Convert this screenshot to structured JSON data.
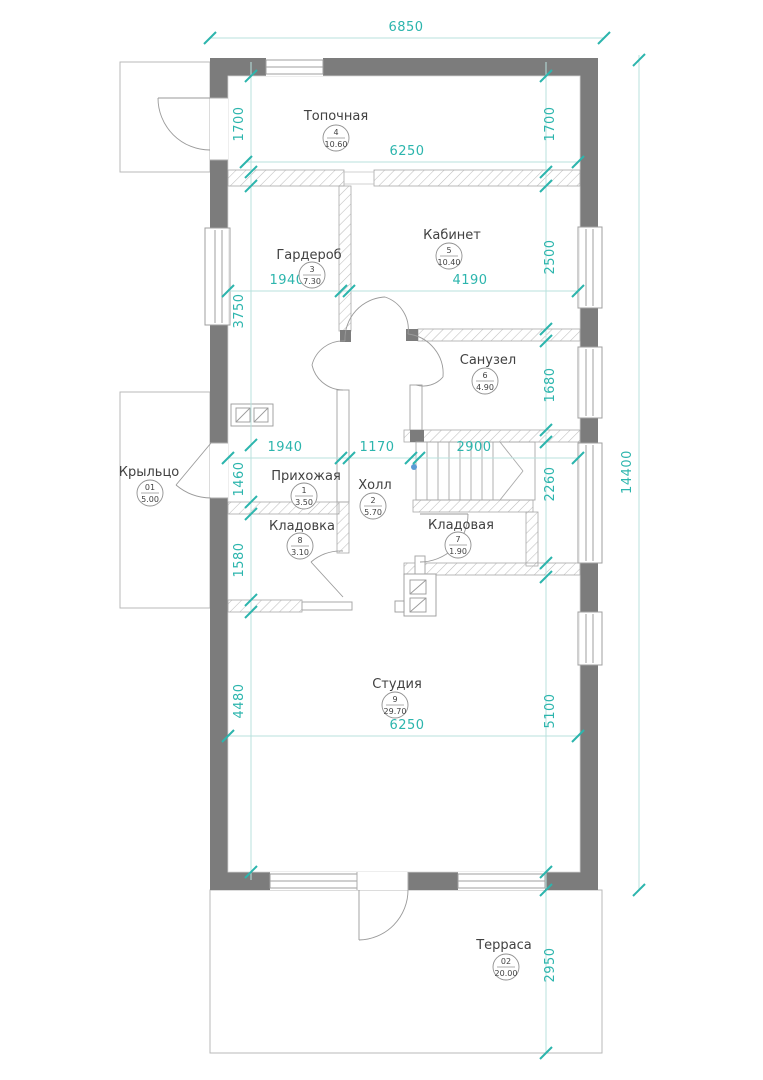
{
  "plan": {
    "title": "floor-plan",
    "colors": {
      "wall": "#7c7c7c",
      "dimension_accent": "#2cb5ad",
      "dimension_line": "#b9e2de",
      "thin_line": "#b9b9b9",
      "text": "#414141",
      "stair_dot": "#5b9bd5"
    },
    "rooms": [
      {
        "name": "Топочная",
        "number": "4",
        "area": "10.60"
      },
      {
        "name": "Гардероб",
        "number": "3",
        "area": "7.30"
      },
      {
        "name": "Кабинет",
        "number": "5",
        "area": "10.40"
      },
      {
        "name": "Санузел",
        "number": "6",
        "area": "4.90"
      },
      {
        "name": "Прихожая",
        "number": "1",
        "area": "3.50"
      },
      {
        "name": "Холл",
        "number": "2",
        "area": "5.70"
      },
      {
        "name": "Кладовка",
        "number": "8",
        "area": "3.10"
      },
      {
        "name": "Кладовая",
        "number": "7",
        "area": "1.90"
      },
      {
        "name": "Студия",
        "number": "9",
        "area": "29.70"
      },
      {
        "name": "Крыльцо",
        "number": "01",
        "area": "5.00"
      },
      {
        "name": "Терраса",
        "number": "02",
        "area": "20.00"
      }
    ],
    "dims": {
      "overall_width": "6850",
      "overall_height": "14400",
      "boiler_left": "1700",
      "boiler_right": "1700",
      "boiler_width": "6250",
      "wardrobe_width": "1940",
      "office_width": "4190",
      "office_height": "2500",
      "wardrobe_height": "3750",
      "bath_height": "1680",
      "entry_width": "1940",
      "hall_width": "1170",
      "stairs_width": "2900",
      "entry_height": "1460",
      "stairs_height": "2260",
      "storeroom_height": "1580",
      "studio_left": "4480",
      "studio_right": "5100",
      "studio_width": "6250",
      "terrace_height": "2950"
    }
  }
}
